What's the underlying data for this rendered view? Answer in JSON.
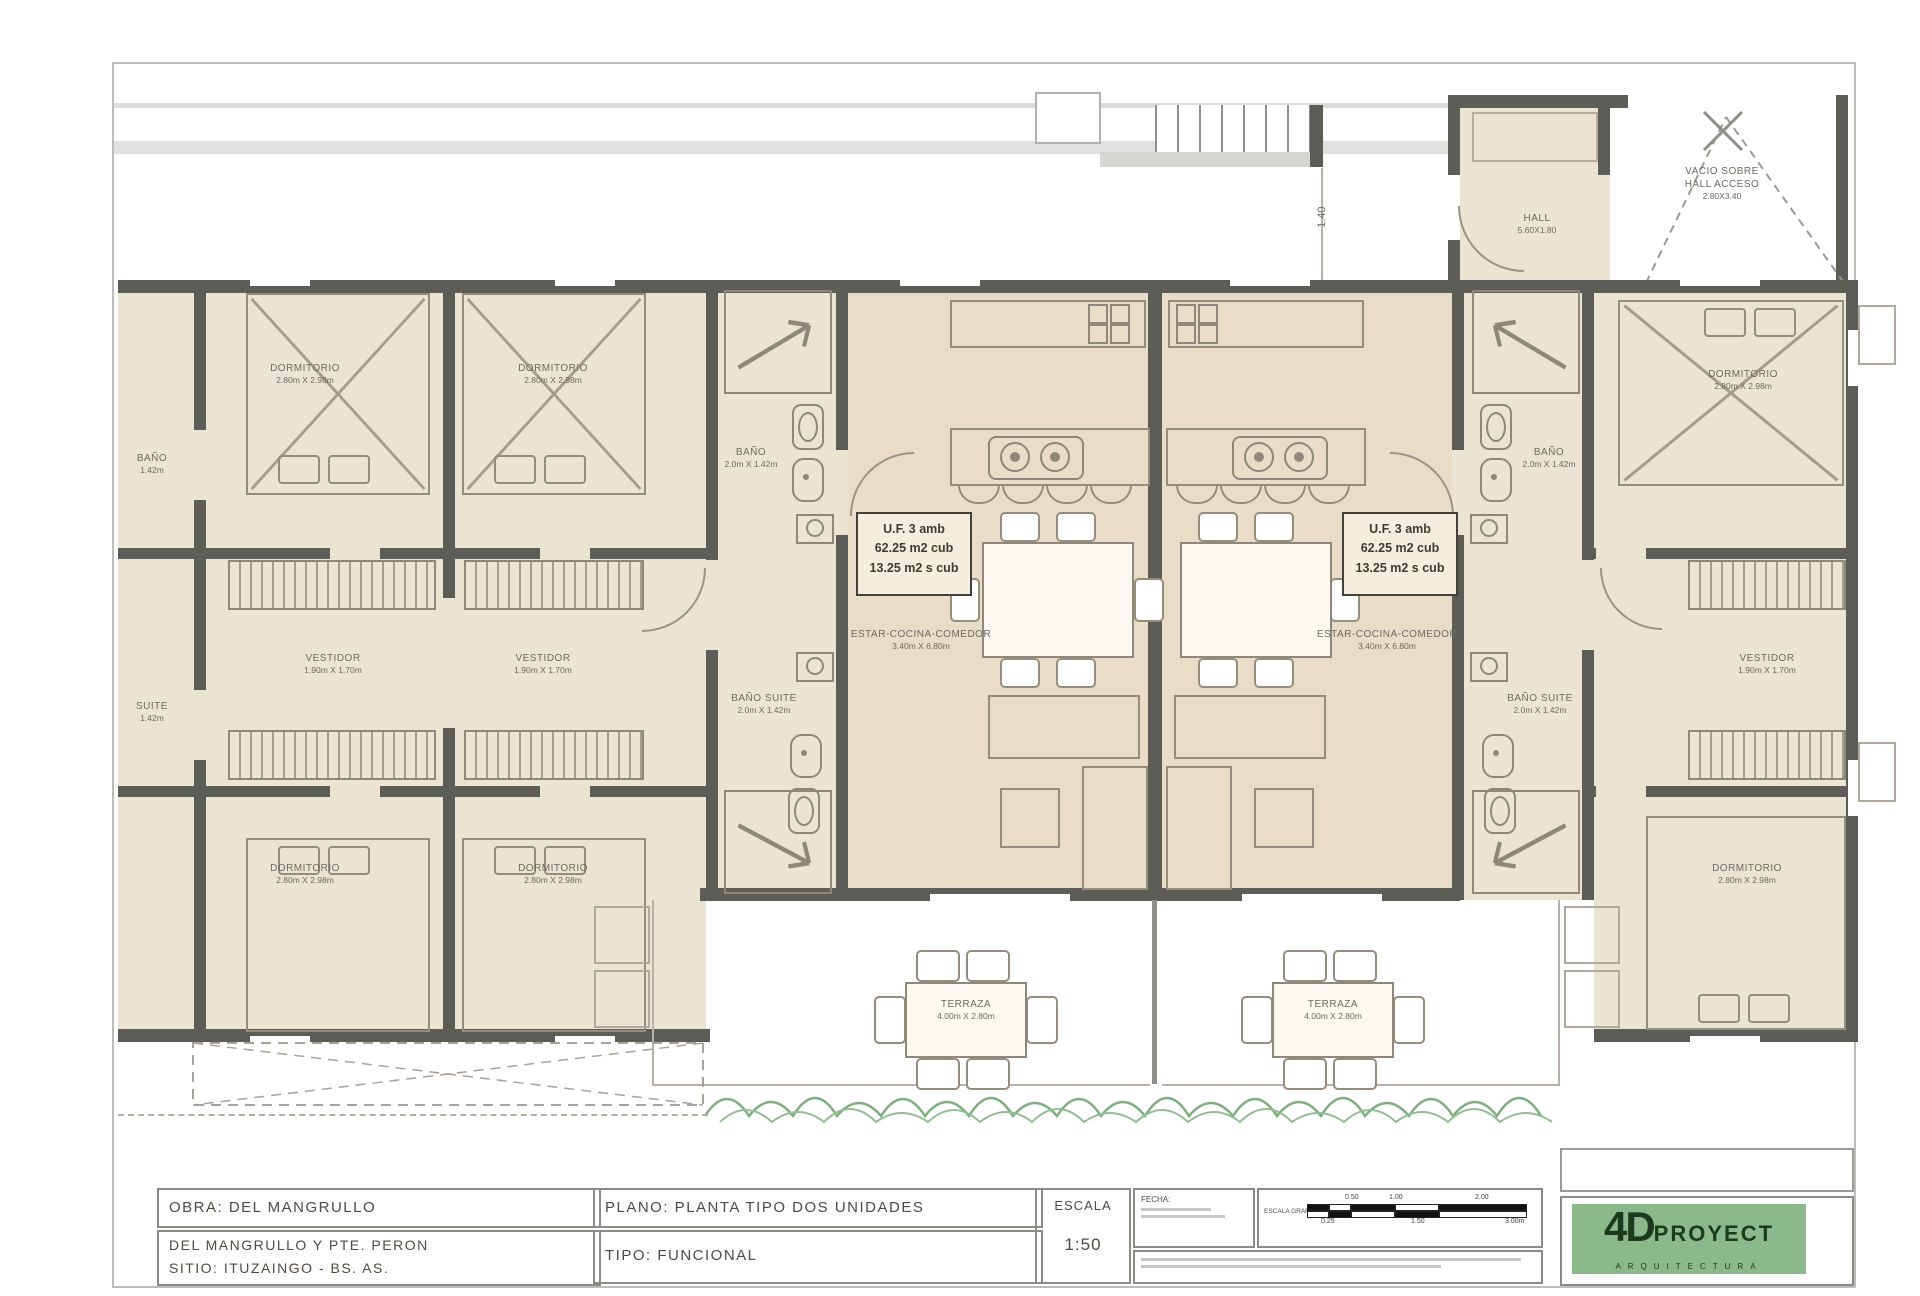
{
  "drawing": {
    "dim_vertical": "1.40",
    "unit_info": {
      "line1": "U.F. 3 amb",
      "line2": "62.25 m2 cub",
      "line3": "13.25 m2 s cub"
    },
    "rooms": {
      "dormitorio": {
        "label": "DORMITORIO",
        "dims": "2.80m X 2.98m"
      },
      "vestidor": {
        "label": "VESTIDOR",
        "dims": "1.90m X 1.70m"
      },
      "bano": {
        "label": "BAÑO",
        "dims": "2.0m X 1.42m"
      },
      "bano_suite": {
        "label": "BAÑO SUITE",
        "dims": "2.0m X 1.42m"
      },
      "estar": {
        "label": "ESTAR-COCINA-COMEDOR",
        "dims": "3.40m X 6.80m"
      },
      "terraza": {
        "label": "TERRAZA",
        "dims": "4.00m X 2.80m"
      },
      "hall": {
        "label": "HALL",
        "dims": "5.60X1.80"
      },
      "vacio": {
        "line1": "VACIO SOBRE",
        "line2": "HALL ACCESO",
        "line3": "2.80X3.40"
      },
      "bano_edge": {
        "label": "BAÑO",
        "dims": "1.42m"
      },
      "suite_edge": {
        "label": "SUITE",
        "dims": "1.42m"
      }
    }
  },
  "titleblock": {
    "obra": "OBRA:  DEL  MANGRULLO",
    "address_line1": "DEL  MANGRULLO  Y  PTE.  PERON",
    "address_line2": "SITIO:  ITUZAINGO  -  BS.  AS.",
    "plano": "PLANO:  PLANTA  TIPO  DOS  UNIDADES",
    "tipo": "TIPO:  FUNCIONAL",
    "escala_label": "ESCALA",
    "escala_value": "1:50",
    "fecha_label": "FECHA:",
    "escala_grafica_label": "ESCALA GRAFICA",
    "scale_ticks_top": [
      "0.50",
      "1.00",
      "2.00"
    ],
    "scale_ticks_bottom": [
      "0.25",
      "1.50",
      "3.00m"
    ],
    "logo": {
      "brand_number": "4D",
      "brand_name": "PROYECT",
      "brand_sub": "ARQUITECTURA"
    }
  },
  "colors": {
    "wall": "#5d5d58",
    "room_fill": "#ece4d3",
    "living_fill": "#e9ddc7",
    "logo_green": "#8cb98c",
    "vegetation_green": "#7fae7f"
  }
}
